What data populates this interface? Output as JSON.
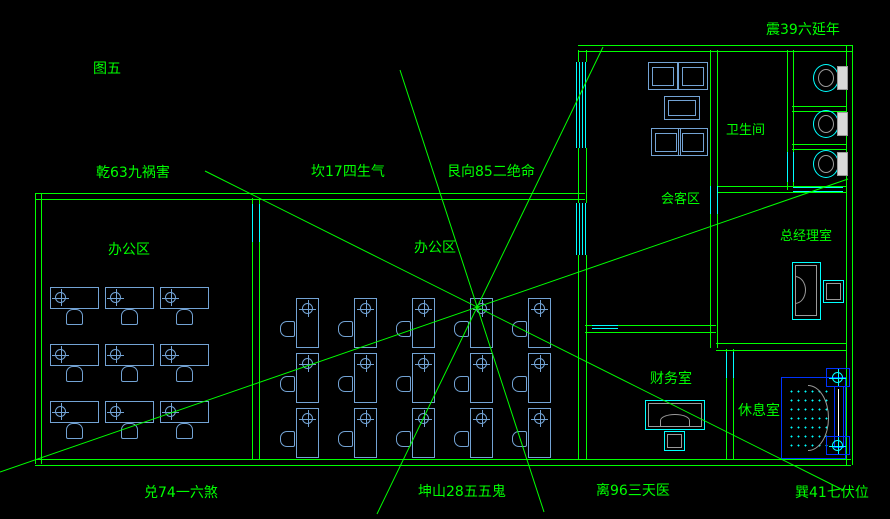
{
  "figure_label": "图五",
  "directions": {
    "zhen": "震39六延年",
    "qian": "乾63九祸害",
    "kan": "坎17四生气",
    "gen": "艮向85二绝命",
    "dui": "兑74一六煞",
    "kun": "坤山28五五鬼",
    "li": "离96三天医",
    "xun": "巽41七伏位"
  },
  "rooms": {
    "office_left": "办公区",
    "office_main": "办公区",
    "meeting": "会客区",
    "bathroom": "卫生间",
    "gm_office": "总经理室",
    "finance": "财务室",
    "lounge": "休息室"
  },
  "furniture": {
    "left_office_desk_count": 9,
    "main_office_desk_count": 15,
    "meeting_chair_count": 4,
    "toilet_count": 3
  },
  "colors": {
    "background": "#000000",
    "wall_and_text_green": "#00ff00",
    "window_cyan": "#00ffff",
    "furniture_blue": "#73a3d4",
    "bed_blue": "#0033ff"
  }
}
